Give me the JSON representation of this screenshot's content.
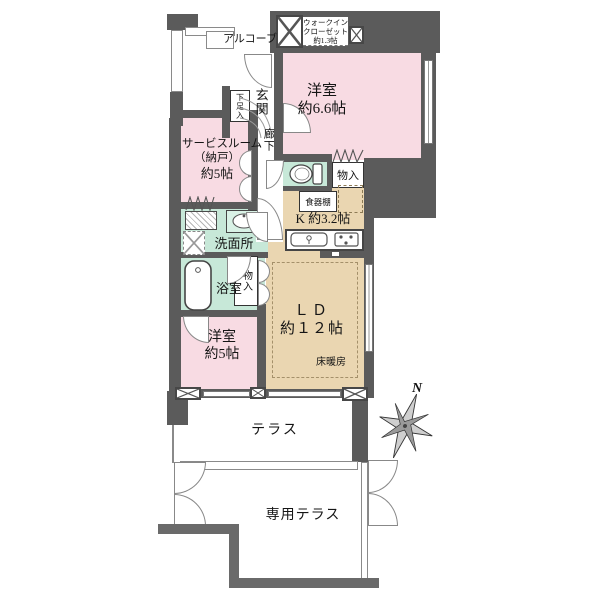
{
  "plan": {
    "labels": {
      "alcove": "アルコーブ",
      "wic_line1": "ウォークイン",
      "wic_line2": "クローゼット",
      "wic_line3": "約1.3帖",
      "genkan": "玄関",
      "shoe_cabinet": "下足入",
      "corridor": "廊下",
      "west_room_66_line1": "洋室",
      "west_room_66_line2": "約6.6帖",
      "service_room_line1": "サービスルーム",
      "service_room_line2": "（納戸）",
      "service_room_line3": "約5帖",
      "washroom": "洗面所",
      "bathroom": "浴室",
      "storage_a": "物入",
      "storage_b": "物入",
      "cupboard": "食器棚",
      "kitchen": "K 約3.2帖",
      "ld_line1": "ＬＤ",
      "ld_line2": "約１２帖",
      "floor_heating": "床暖房",
      "west_room_5_line1": "洋室",
      "west_room_5_line2": "約5帖",
      "terrace": "テラス",
      "private_terrace": "専用テラス"
    },
    "compass": {
      "north": "N"
    },
    "colors": {
      "room_pink": "#f8dbe3",
      "room_beige": "#ead6b1",
      "room_green": "#c7e8d8",
      "wall_gray": "#5b5b5b",
      "background": "#ffffff"
    }
  }
}
